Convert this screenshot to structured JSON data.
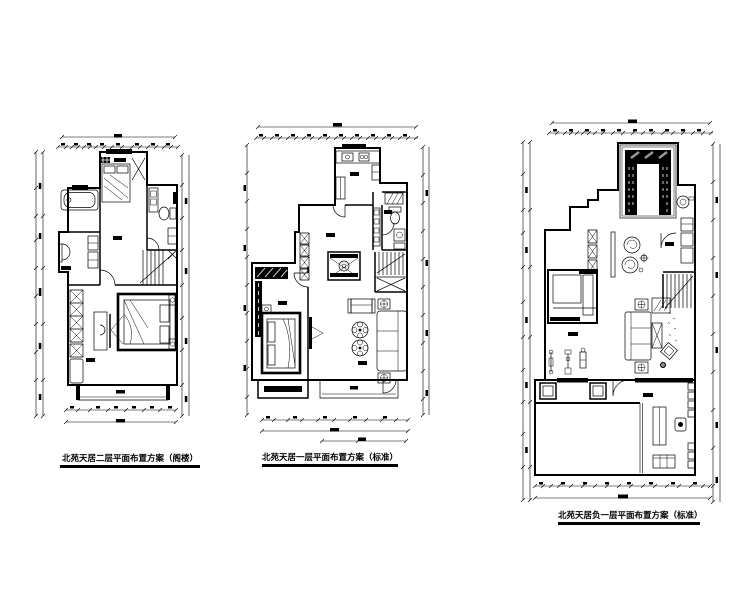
{
  "sheet": {
    "background_color": "#ffffff",
    "ink_color": "#000000",
    "hatch_gray_color": "#999999",
    "plans": [
      {
        "id": "plan-1",
        "caption": "北苑天居二层平面布置方案（阁楼）"
      },
      {
        "id": "plan-2",
        "caption": "北苑天居一层平面布置方案（标准）"
      },
      {
        "id": "plan-3",
        "caption": "北苑天居负一层平面布置方案（标准）"
      }
    ]
  }
}
